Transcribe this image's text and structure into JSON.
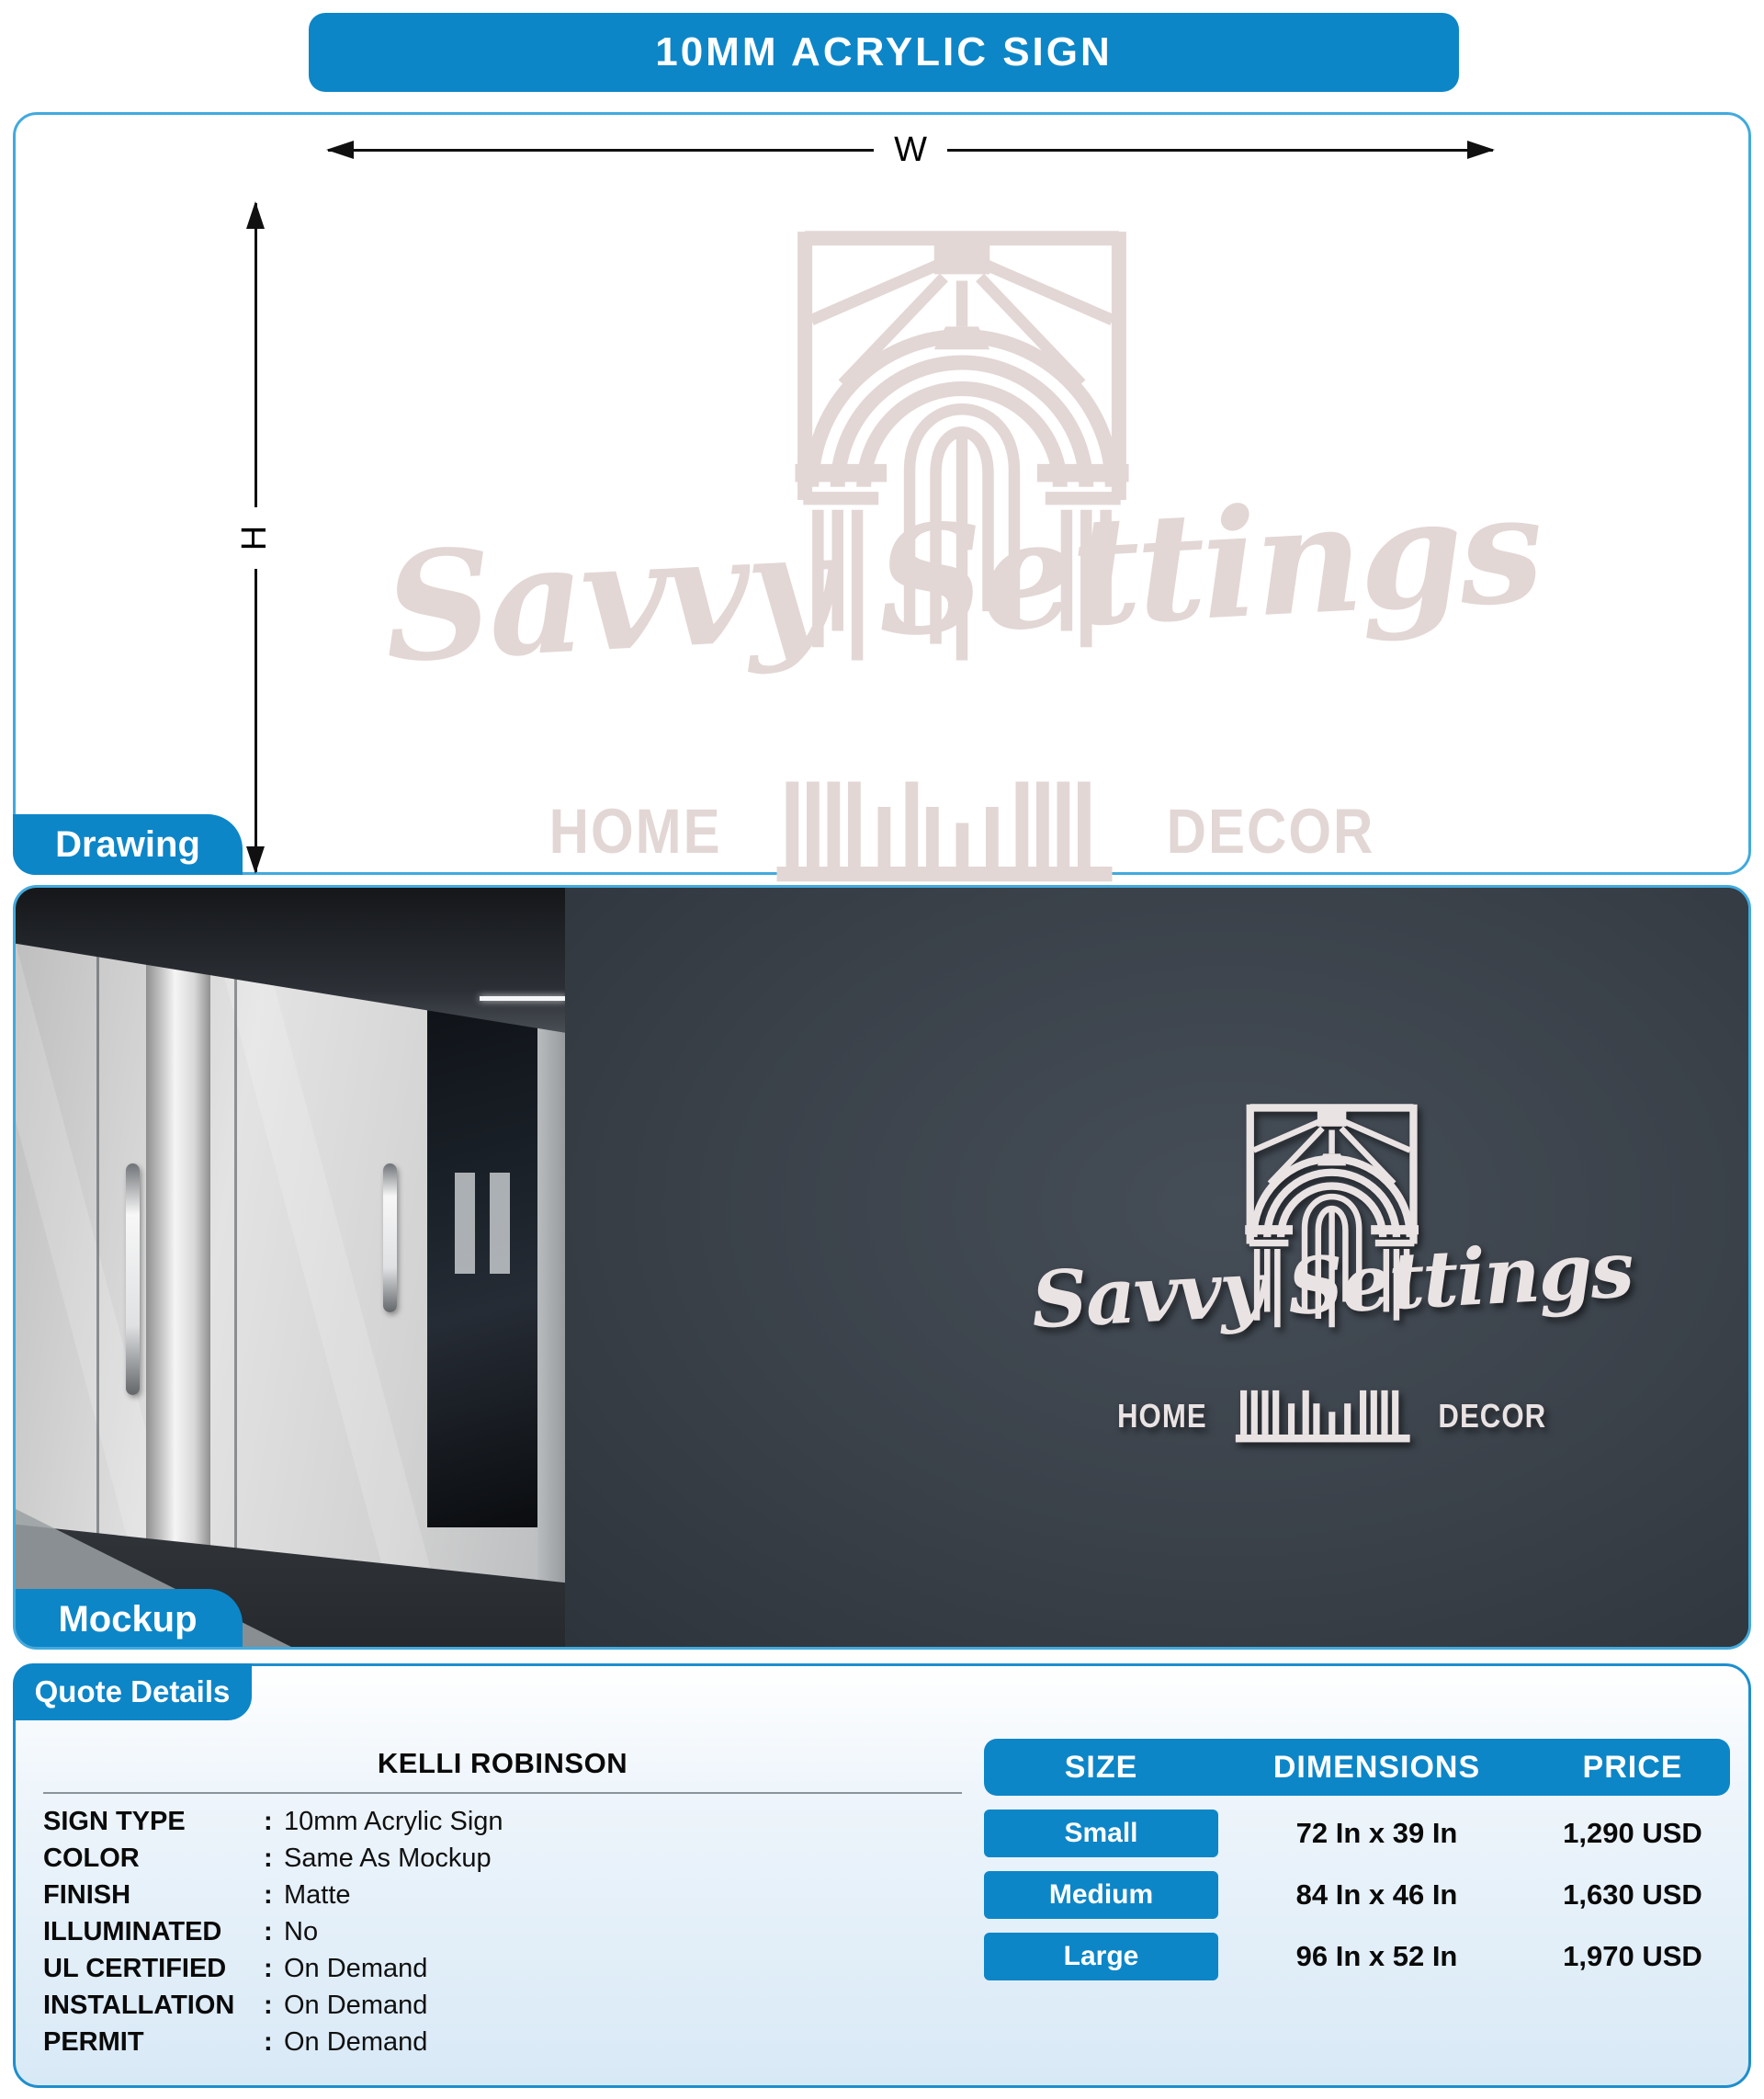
{
  "header": {
    "title": "10MM ACRYLIC SIGN"
  },
  "drawing": {
    "tag": "Drawing",
    "width_label": "W",
    "height_label": "H"
  },
  "logo": {
    "brand": "Savvy Settings",
    "word_left": "HOME",
    "word_right": "DECOR"
  },
  "mockup": {
    "tag": "Mockup"
  },
  "quote": {
    "tag": "Quote Details",
    "customer": "KELLI ROBINSON",
    "separator": ":",
    "specs": [
      {
        "label": "SIGN TYPE",
        "value": "10mm Acrylic Sign"
      },
      {
        "label": "COLOR",
        "value": "Same As Mockup"
      },
      {
        "label": "FINISH",
        "value": "Matte"
      },
      {
        "label": "ILLUMINATED",
        "value": "No"
      },
      {
        "label": "UL CERTIFIED",
        "value": "On Demand"
      },
      {
        "label": "INSTALLATION",
        "value": "On Demand"
      },
      {
        "label": "PERMIT",
        "value": "On Demand"
      }
    ],
    "table": {
      "headers": [
        "SIZE",
        "DIMENSIONS",
        "PRICE"
      ],
      "rows": [
        {
          "size": "Small",
          "dimensions": "72 In x 39 In",
          "price": "1,290 USD"
        },
        {
          "size": "Medium",
          "dimensions": "84 In x 46 In",
          "price": "1,630 USD"
        },
        {
          "size": "Large",
          "dimensions": "96 In x 52 In",
          "price": "1,970 USD"
        }
      ]
    }
  },
  "colors": {
    "accent_blue": "#0d86c8",
    "panel_border_blue": "#41aade",
    "logo_pink": "#e2d7d5",
    "mockup_wall": "#3a4149",
    "sign_white": "#eae3e3"
  }
}
